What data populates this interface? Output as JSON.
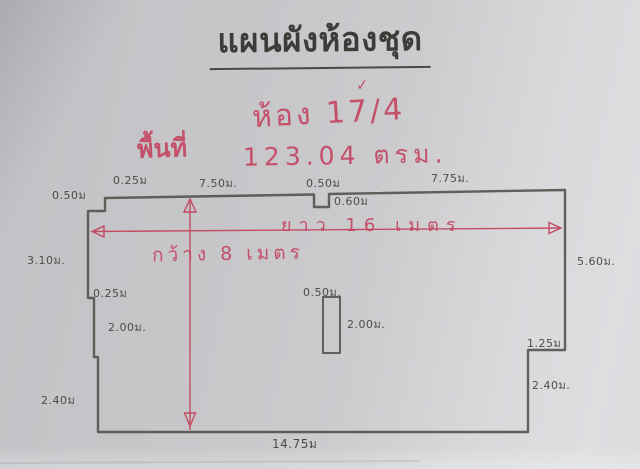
{
  "photo": {
    "title": "แผนผังห้องชุด",
    "handwritten": {
      "check": "✓",
      "room": "ห้อง 17/4",
      "area_label": "พื้นที่",
      "area_value": "123.04 ตรม.",
      "length": "ยาว 16 เมตร",
      "width": "กว้าง 8 เมตร"
    },
    "plan": {
      "overall_length_m": 16,
      "overall_width_m": 8,
      "area_sqm": "123.04",
      "dims": [
        {
          "id": "top-left-notch-depth",
          "text": "0.50ม"
        },
        {
          "id": "top-left-notch-width",
          "text": "0.25ม"
        },
        {
          "id": "top-segment-left",
          "text": "7.50ม."
        },
        {
          "id": "top-notch-width",
          "text": "0.50ม"
        },
        {
          "id": "top-notch-depth",
          "text": "0.60ม"
        },
        {
          "id": "top-segment-right",
          "text": "7.75ม."
        },
        {
          "id": "left-wall-upper",
          "text": "3.10ม."
        },
        {
          "id": "right-wall-upper",
          "text": "5.60ม."
        },
        {
          "id": "left-step",
          "text": "0.25ม"
        },
        {
          "id": "left-wall-middle",
          "text": "2.00ม."
        },
        {
          "id": "column-width",
          "text": "0.50ม."
        },
        {
          "id": "column-height",
          "text": "2.00ม."
        },
        {
          "id": "right-step",
          "text": "1.25ม"
        },
        {
          "id": "right-wall-lower",
          "text": "2.40ม."
        },
        {
          "id": "left-wall-lower",
          "text": "2.40ม"
        },
        {
          "id": "bottom-wall",
          "text": "14.75ม"
        }
      ]
    },
    "colors": {
      "paper": "#cac9cc",
      "pencil": "#524f49",
      "red_ink": "#c4506a"
    }
  }
}
